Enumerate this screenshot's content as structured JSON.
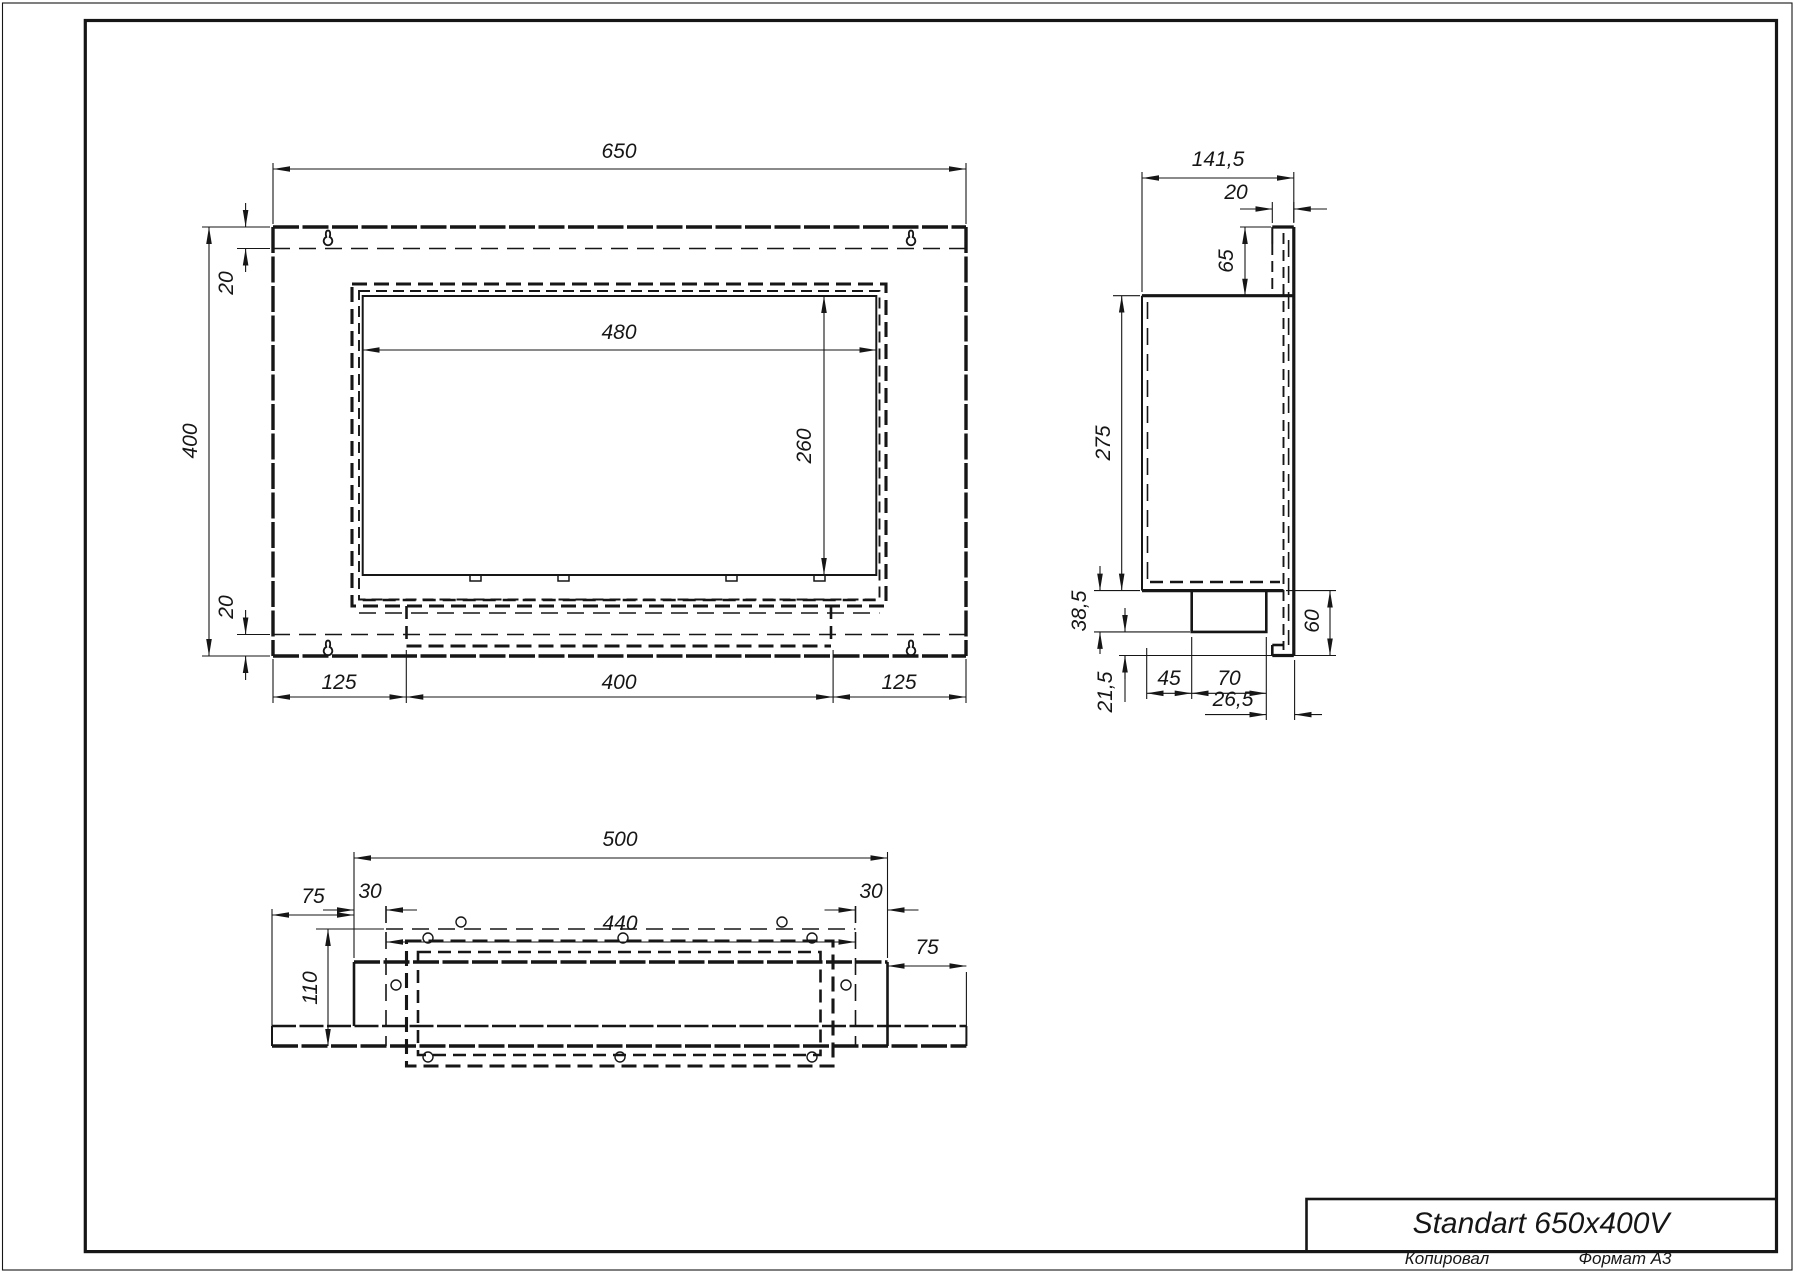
{
  "colors": {
    "ink": "#161616",
    "paper": "#ffffff"
  },
  "title_block": {
    "title": "Standart 650x400V"
  },
  "footer": {
    "copied_by": "Копировал",
    "format": "Формат А3"
  },
  "front_view": {
    "width": "650",
    "height": "400",
    "offset_top": "20",
    "offset_bottom": "20",
    "opening_width": "480",
    "opening_height": "260",
    "bottom_left": "125",
    "bottom_center": "400",
    "bottom_right": "125"
  },
  "side_view": {
    "depth": "141,5",
    "tab_depth": "20",
    "tab_height": "65",
    "body_height": "275",
    "base_drop": "38,5",
    "foot_drop": "21,5",
    "foot_offset": "45",
    "foot_width": "70",
    "foot_to_face": "26,5",
    "flange_height": "60"
  },
  "bottom_view": {
    "width": "500",
    "opening_width": "440",
    "margin_left": "30",
    "margin_right": "30",
    "plate_left": "75",
    "plate_right": "75",
    "depth": "110"
  }
}
